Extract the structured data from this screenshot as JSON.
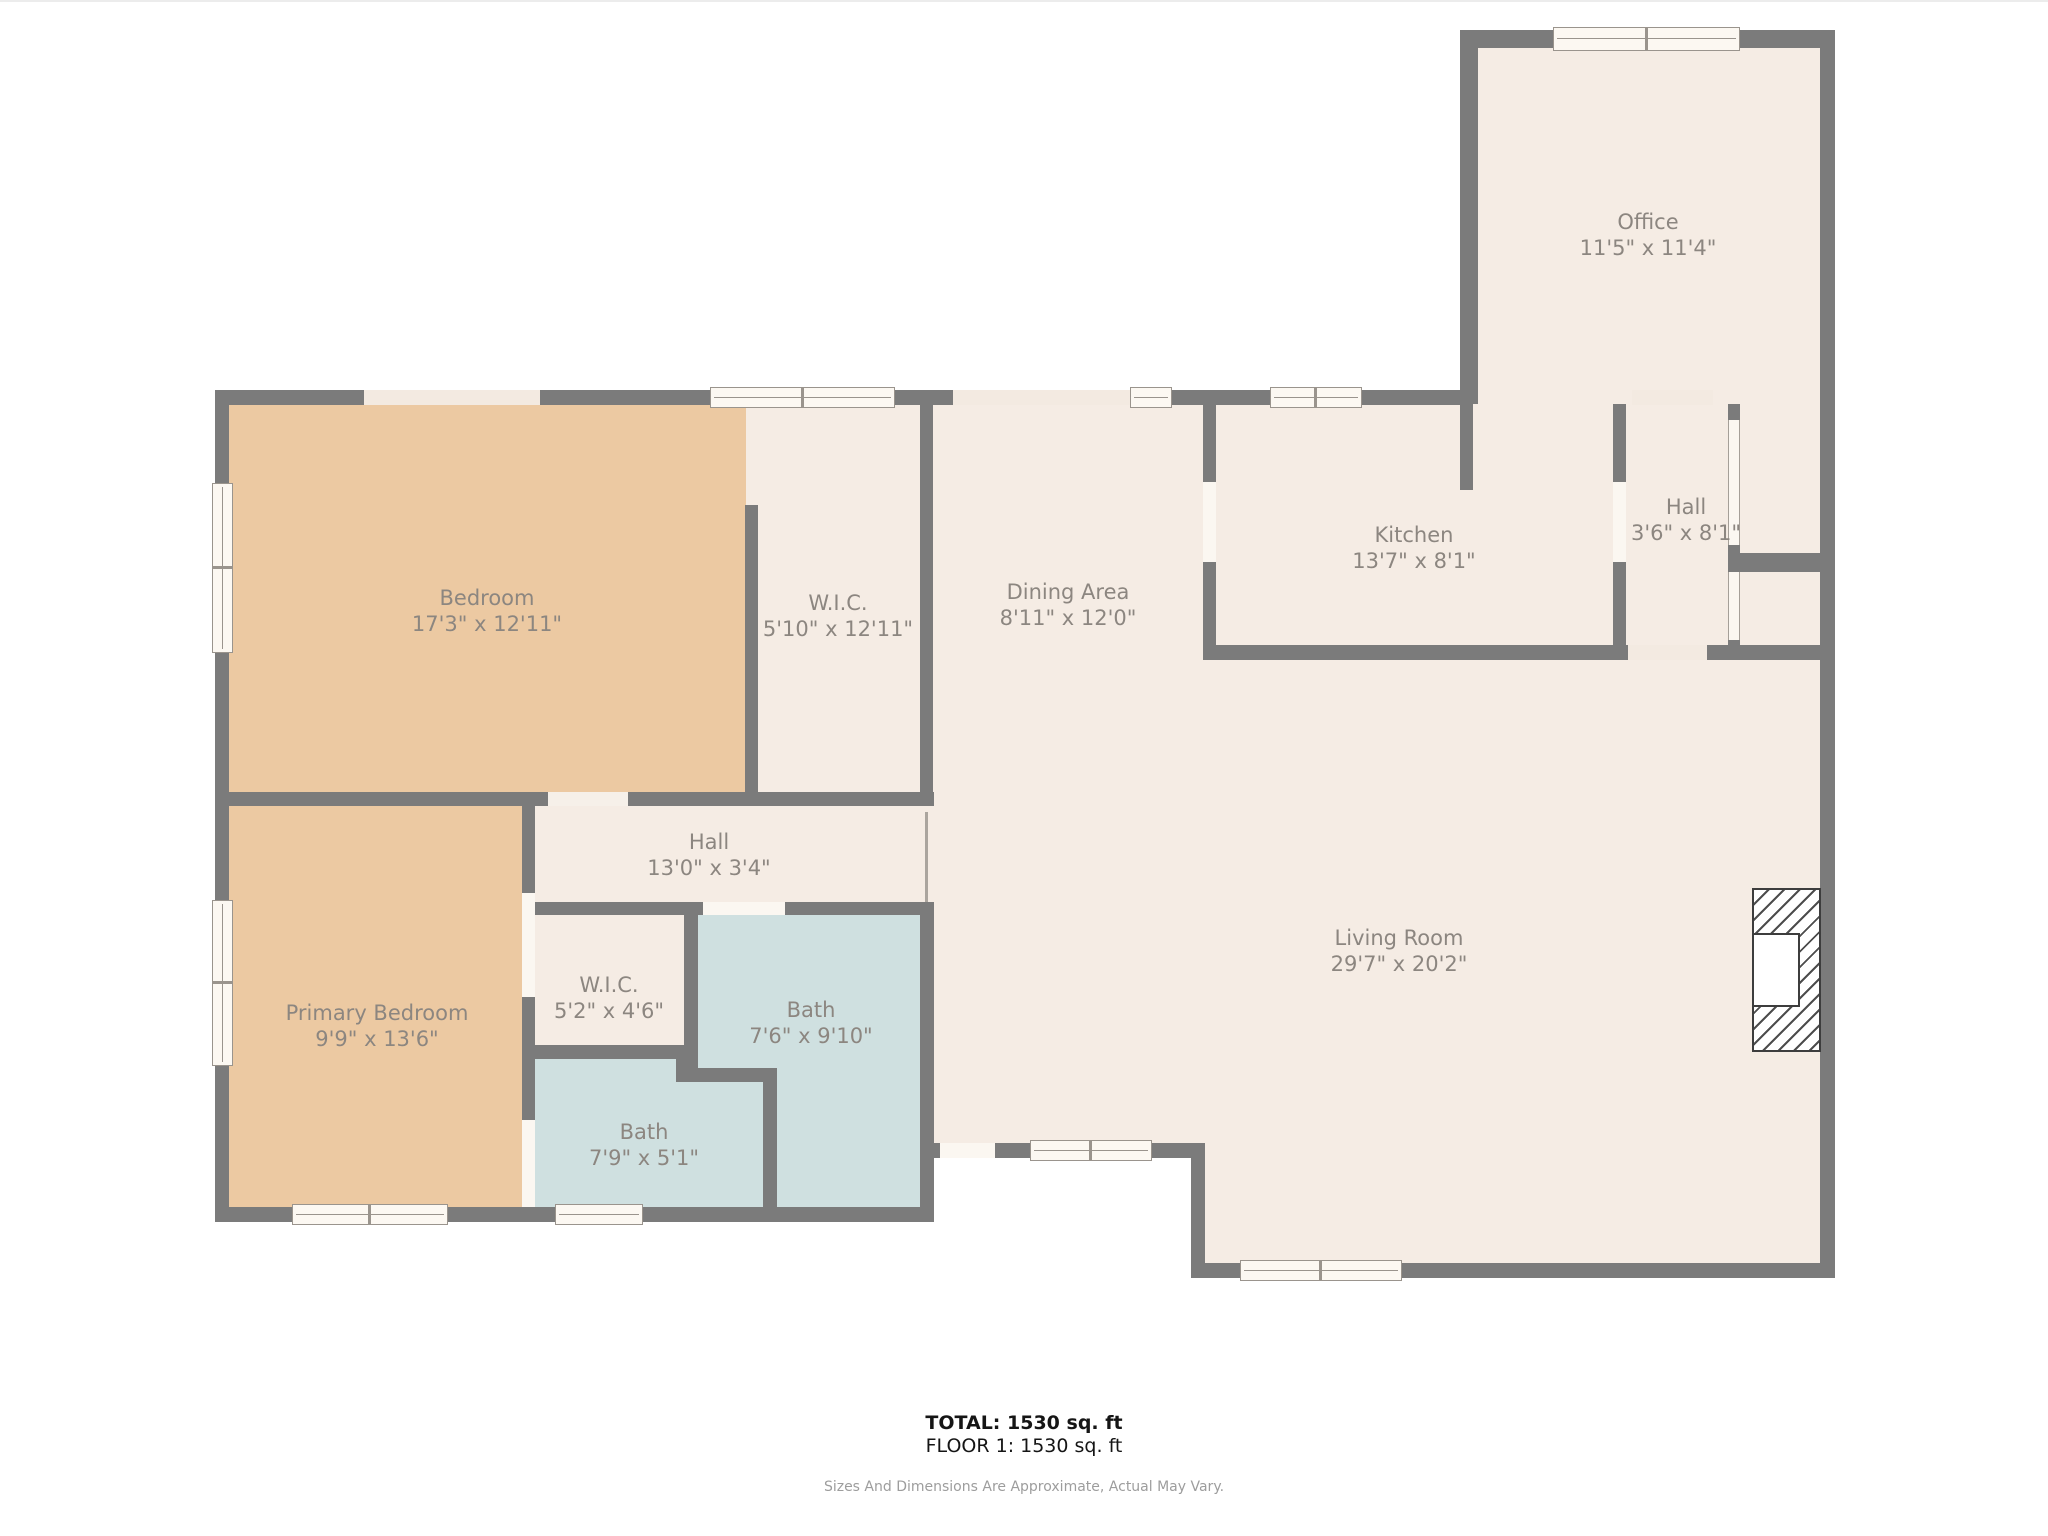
{
  "plan": {
    "type": "floor-plan",
    "floor_label": "FLOOR 1",
    "total_area_sqft": 1530
  },
  "colors": {
    "wall": "#7b7b7b",
    "room_fill": "#f5ece4",
    "bedroom_fill": "#ecc9a2",
    "bath_fill": "#cfe0e0",
    "window_fill": "#fcf8f2",
    "label_text": "#8c8680",
    "footer_text": "#151515",
    "disclaimer_text": "#9d9d9d",
    "background": "#ffffff"
  },
  "rooms": [
    {
      "id": "bedroom",
      "name": "Bedroom",
      "dims": "17'3\" x 12'11\""
    },
    {
      "id": "wic-1",
      "name": "W.I.C.",
      "dims": "5'10\" x 12'11\""
    },
    {
      "id": "dining-area",
      "name": "Dining Area",
      "dims": "8'11\" x 12'0\""
    },
    {
      "id": "kitchen",
      "name": "Kitchen",
      "dims": "13'7\" x 8'1\""
    },
    {
      "id": "hall-upper",
      "name": "Hall",
      "dims": "3'6\" x 8'1\""
    },
    {
      "id": "office",
      "name": "Office",
      "dims": "11'5\" x 11'4\""
    },
    {
      "id": "hall-lower",
      "name": "Hall",
      "dims": "13'0\" x 3'4\""
    },
    {
      "id": "primary-bedroom",
      "name": "Primary Bedroom",
      "dims": "9'9\" x 13'6\""
    },
    {
      "id": "wic-2",
      "name": "W.I.C.",
      "dims": "5'2\" x 4'6\""
    },
    {
      "id": "bath-1",
      "name": "Bath",
      "dims": "7'6\" x 9'10\""
    },
    {
      "id": "bath-2",
      "name": "Bath",
      "dims": "7'9\" x 5'1\""
    },
    {
      "id": "living-room",
      "name": "Living Room",
      "dims": "29'7\" x 20'2\""
    }
  ],
  "footer": {
    "total": "TOTAL: 1530 sq. ft",
    "floor": "FLOOR 1: 1530 sq. ft",
    "disclaimer": "Sizes And Dimensions Are Approximate, Actual May Vary."
  }
}
